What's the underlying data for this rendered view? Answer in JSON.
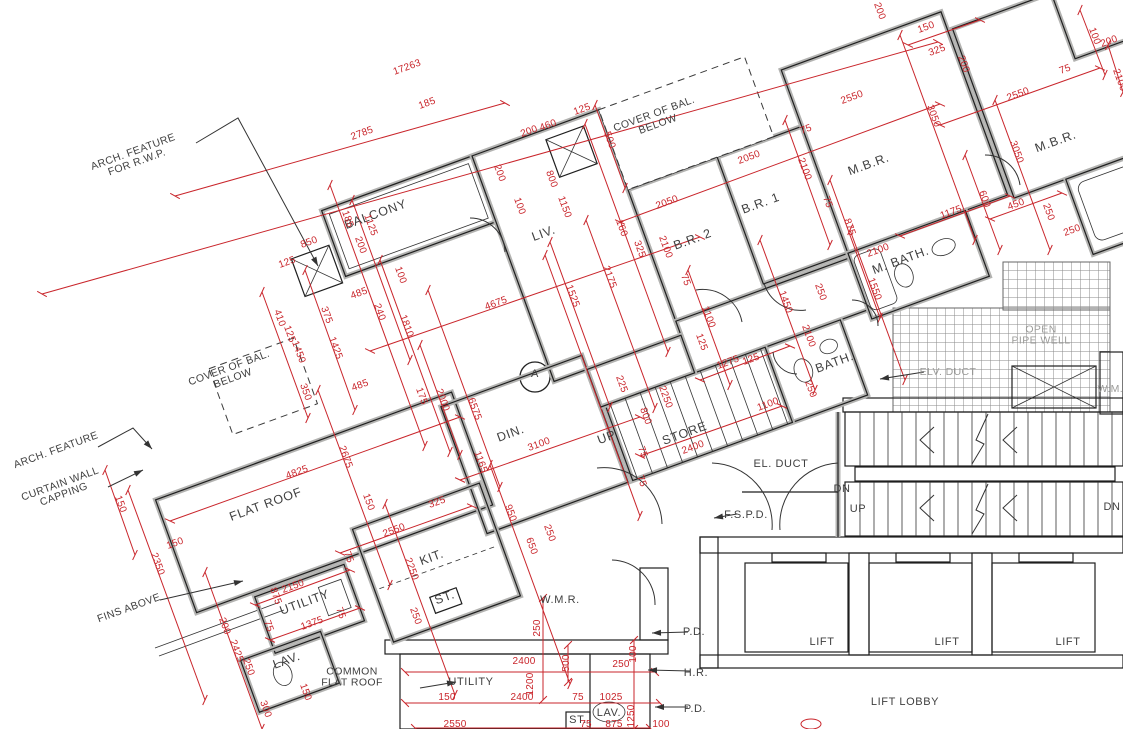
{
  "drawing": {
    "type": "architectural floor plan",
    "flat_marker": "A"
  },
  "colors": {
    "dimension_red": "#c9252b",
    "room_fill": "#e9f0f7",
    "teal_room_fill": "#cfe2e0",
    "wall_gray": "#b3b3b1",
    "line_black": "#222222",
    "muted_text": "#9b9b99",
    "label_text": "#3f3f3f"
  },
  "room_labels": [
    {
      "text": "BALCONY",
      "x": 377,
      "y": 218,
      "angle": -20
    },
    {
      "text": "LIV.",
      "x": 545,
      "y": 237,
      "angle": -20
    },
    {
      "text": "DIN.",
      "x": 512,
      "y": 437,
      "angle": -20
    },
    {
      "text": "B.R. 2",
      "x": 694,
      "y": 243,
      "angle": -20
    },
    {
      "text": "B.R. 1",
      "x": 762,
      "y": 207,
      "angle": -20
    },
    {
      "text": "M.B.R.",
      "x": 870,
      "y": 168,
      "angle": -20
    },
    {
      "text": "M.B.R.",
      "x": 1057,
      "y": 145,
      "angle": -20
    },
    {
      "text": "M. BATH.",
      "x": 902,
      "y": 264,
      "angle": -20,
      "size": 10
    },
    {
      "text": "BATH.",
      "x": 836,
      "y": 366,
      "angle": -20,
      "size": 10
    },
    {
      "text": "KIT.",
      "x": 433,
      "y": 561,
      "angle": -20
    },
    {
      "text": "STORE",
      "x": 686,
      "y": 437,
      "angle": -20,
      "size": 10
    },
    {
      "text": "UP",
      "x": 608,
      "y": 441,
      "angle": -20,
      "size": 10
    },
    {
      "text": "FLAT ROOF",
      "x": 267,
      "y": 508,
      "angle": -20
    },
    {
      "text": "UTILITY",
      "x": 306,
      "y": 606,
      "angle": -20,
      "size": 10
    },
    {
      "text": "LAV.",
      "x": 288,
      "y": 664,
      "angle": -20,
      "size": 10
    },
    {
      "text": "ST.",
      "x": 446,
      "y": 601,
      "angle": -20,
      "size": 9
    }
  ],
  "core_labels": [
    {
      "text": "UTILITY",
      "x": 471,
      "y": 685,
      "size": 11
    },
    {
      "text": "LAV.",
      "x": 609,
      "y": 716,
      "size": 9
    },
    {
      "text": "ST.",
      "x": 578,
      "y": 723,
      "size": 9
    },
    {
      "text": "W.M.R.",
      "x": 560,
      "y": 603
    },
    {
      "text": "LIFT",
      "x": 822,
      "y": 645
    },
    {
      "text": "LIFT",
      "x": 947,
      "y": 645
    },
    {
      "text": "LIFT",
      "x": 1068,
      "y": 645
    },
    {
      "text": "LIFT LOBBY",
      "x": 905,
      "y": 705
    },
    {
      "text": "EL. DUCT",
      "x": 781,
      "y": 467,
      "size": 10.5
    },
    {
      "text": "F.S.P.D.",
      "x": 746,
      "y": 518,
      "size": 10.5
    },
    {
      "text": "DN",
      "x": 842,
      "y": 492,
      "size": 10.5
    },
    {
      "text": "UP",
      "x": 858,
      "y": 512,
      "size": 10.5
    },
    {
      "text": "DN",
      "x": 1112,
      "y": 510,
      "size": 10.5
    },
    {
      "text": "P.D.",
      "x": 694,
      "y": 635,
      "size": 10.5
    },
    {
      "text": "H.R.",
      "x": 696,
      "y": 676,
      "size": 10.5
    },
    {
      "text": "P.D.",
      "x": 695,
      "y": 712,
      "size": 10.5
    }
  ],
  "muted_labels": [
    {
      "text": "OPEN\nPIPE WELL",
      "x": 1041,
      "y": 338
    },
    {
      "text": "ELV. DUCT",
      "x": 948,
      "y": 375
    },
    {
      "text": "W.M.R.",
      "x": 1116,
      "y": 392
    }
  ],
  "annotations": [
    {
      "text": "ARCH. FEATURE\nFOR R.W.P.",
      "x": 136,
      "y": 160,
      "angle": -20
    },
    {
      "text": "COVER OF BAL.\nBELOW",
      "x": 657,
      "y": 122,
      "angle": -20
    },
    {
      "text": "COVER OF BAL.\nBELOW",
      "x": 232,
      "y": 376,
      "angle": -20
    },
    {
      "text": "ARCH. FEATURE",
      "x": 57,
      "y": 453,
      "angle": -20
    },
    {
      "text": "CURTAIN WALL\nCAPPING",
      "x": 63,
      "y": 492,
      "angle": -20
    },
    {
      "text": "FINS ABOVE",
      "x": 130,
      "y": 611,
      "angle": -20
    },
    {
      "text": "COMMON\nFLAT ROOF",
      "x": 352,
      "y": 680
    }
  ],
  "flat_marker_label": {
    "text": "A",
    "x": 535,
    "y": 377
  },
  "dimensions": [
    {
      "text": "17263",
      "x": 408,
      "y": 70,
      "angle": -20
    },
    {
      "text": "2785",
      "x": 363,
      "y": 136,
      "angle": -20
    },
    {
      "text": "185",
      "x": 428,
      "y": 106,
      "angle": -20
    },
    {
      "text": "185",
      "x": 345,
      "y": 220,
      "angle": 70
    },
    {
      "text": "1125",
      "x": 368,
      "y": 226,
      "angle": 70
    },
    {
      "text": "200",
      "x": 358,
      "y": 246,
      "angle": 70
    },
    {
      "text": "100",
      "x": 398,
      "y": 276,
      "angle": 70
    },
    {
      "text": "850",
      "x": 310,
      "y": 245,
      "angle": -20
    },
    {
      "text": "125",
      "x": 288,
      "y": 265,
      "angle": -20
    },
    {
      "text": "485",
      "x": 360,
      "y": 296,
      "angle": -20
    },
    {
      "text": "240",
      "x": 377,
      "y": 313,
      "angle": 70
    },
    {
      "text": "1810",
      "x": 404,
      "y": 327,
      "angle": 70
    },
    {
      "text": "200",
      "x": 530,
      "y": 134,
      "angle": -20
    },
    {
      "text": "460",
      "x": 549,
      "y": 128,
      "angle": -20
    },
    {
      "text": "125",
      "x": 583,
      "y": 112,
      "angle": -20
    },
    {
      "text": "500",
      "x": 607,
      "y": 141,
      "angle": 70
    },
    {
      "text": "800",
      "x": 549,
      "y": 180,
      "angle": 70
    },
    {
      "text": "200",
      "x": 497,
      "y": 174,
      "angle": 70
    },
    {
      "text": "100",
      "x": 517,
      "y": 207,
      "angle": 70
    },
    {
      "text": "1150",
      "x": 562,
      "y": 208,
      "angle": 70
    },
    {
      "text": "4675",
      "x": 497,
      "y": 306,
      "angle": -20
    },
    {
      "text": "1525",
      "x": 570,
      "y": 297,
      "angle": 70
    },
    {
      "text": "2175",
      "x": 607,
      "y": 278,
      "angle": 70
    },
    {
      "text": "160",
      "x": 619,
      "y": 229,
      "angle": 70
    },
    {
      "text": "325",
      "x": 637,
      "y": 250,
      "angle": 70
    },
    {
      "text": "2100",
      "x": 663,
      "y": 248,
      "angle": 70
    },
    {
      "text": "2050",
      "x": 668,
      "y": 205,
      "angle": -20
    },
    {
      "text": "75",
      "x": 807,
      "y": 132,
      "angle": -20
    },
    {
      "text": "2050",
      "x": 750,
      "y": 160,
      "angle": -20
    },
    {
      "text": "2550",
      "x": 853,
      "y": 100,
      "angle": -20
    },
    {
      "text": "3050",
      "x": 931,
      "y": 117,
      "angle": 70
    },
    {
      "text": "2100",
      "x": 802,
      "y": 170,
      "angle": 70
    },
    {
      "text": "75",
      "x": 825,
      "y": 203,
      "angle": 70
    },
    {
      "text": "875",
      "x": 847,
      "y": 228,
      "angle": 70
    },
    {
      "text": "1175",
      "x": 952,
      "y": 215,
      "angle": -20
    },
    {
      "text": "600",
      "x": 982,
      "y": 200,
      "angle": 70
    },
    {
      "text": "1450",
      "x": 783,
      "y": 303,
      "angle": 70
    },
    {
      "text": "1550",
      "x": 872,
      "y": 290,
      "angle": 70
    },
    {
      "text": "250",
      "x": 818,
      "y": 293,
      "angle": 70
    },
    {
      "text": "2100",
      "x": 879,
      "y": 253,
      "angle": -20
    },
    {
      "text": "75",
      "x": 683,
      "y": 281,
      "angle": 70
    },
    {
      "text": "1100",
      "x": 706,
      "y": 318,
      "angle": 70
    },
    {
      "text": "125",
      "x": 699,
      "y": 343,
      "angle": 70
    },
    {
      "text": "1275",
      "x": 729,
      "y": 365,
      "angle": -20
    },
    {
      "text": "125",
      "x": 752,
      "y": 362,
      "angle": -20
    },
    {
      "text": "2100",
      "x": 806,
      "y": 337,
      "angle": 70
    },
    {
      "text": "250",
      "x": 808,
      "y": 390,
      "angle": 70
    },
    {
      "text": "225",
      "x": 619,
      "y": 385,
      "angle": 70
    },
    {
      "text": "800",
      "x": 643,
      "y": 417,
      "angle": 70
    },
    {
      "text": "2250",
      "x": 663,
      "y": 398,
      "angle": 70
    },
    {
      "text": "2400",
      "x": 694,
      "y": 450,
      "angle": -20
    },
    {
      "text": "1100",
      "x": 769,
      "y": 407,
      "angle": -20
    },
    {
      "text": "75",
      "x": 640,
      "y": 453,
      "angle": 70
    },
    {
      "text": "75",
      "x": 639,
      "y": 482,
      "angle": 70
    },
    {
      "text": "175",
      "x": 419,
      "y": 397,
      "angle": 70
    },
    {
      "text": "2000",
      "x": 440,
      "y": 401,
      "angle": 70
    },
    {
      "text": "6575",
      "x": 472,
      "y": 410,
      "angle": 70
    },
    {
      "text": "1165",
      "x": 478,
      "y": 463,
      "angle": 70
    },
    {
      "text": "3100",
      "x": 540,
      "y": 447,
      "angle": -20
    },
    {
      "text": "325",
      "x": 438,
      "y": 505,
      "angle": -20
    },
    {
      "text": "950",
      "x": 508,
      "y": 514,
      "angle": 70
    },
    {
      "text": "650",
      "x": 529,
      "y": 547,
      "angle": 70
    },
    {
      "text": "250",
      "x": 547,
      "y": 534,
      "angle": 70
    },
    {
      "text": "150",
      "x": 366,
      "y": 503,
      "angle": 70
    },
    {
      "text": "2550",
      "x": 395,
      "y": 533,
      "angle": -20
    },
    {
      "text": "2250",
      "x": 409,
      "y": 570,
      "angle": 70
    },
    {
      "text": "75",
      "x": 346,
      "y": 558,
      "angle": 70
    },
    {
      "text": "250",
      "x": 413,
      "y": 617,
      "angle": 70
    },
    {
      "text": "4825",
      "x": 298,
      "y": 475,
      "angle": -20
    },
    {
      "text": "2675",
      "x": 343,
      "y": 458,
      "angle": 70
    },
    {
      "text": "485",
      "x": 361,
      "y": 388,
      "angle": -20
    },
    {
      "text": "350",
      "x": 303,
      "y": 393,
      "angle": 70
    },
    {
      "text": "1425",
      "x": 333,
      "y": 349,
      "angle": 70
    },
    {
      "text": "375",
      "x": 324,
      "y": 316,
      "angle": 70
    },
    {
      "text": "410",
      "x": 277,
      "y": 319,
      "angle": 70
    },
    {
      "text": "125",
      "x": 287,
      "y": 335,
      "angle": 70
    },
    {
      "text": "1450",
      "x": 296,
      "y": 353,
      "angle": 70
    },
    {
      "text": "150",
      "x": 118,
      "y": 505,
      "angle": 70
    },
    {
      "text": "150",
      "x": 176,
      "y": 546,
      "angle": -20
    },
    {
      "text": "2350",
      "x": 155,
      "y": 565,
      "angle": 70
    },
    {
      "text": "200",
      "x": 222,
      "y": 627,
      "angle": 70
    },
    {
      "text": "2425",
      "x": 234,
      "y": 652,
      "angle": 70
    },
    {
      "text": "250",
      "x": 246,
      "y": 668,
      "angle": 70
    },
    {
      "text": "300",
      "x": 263,
      "y": 710,
      "angle": 70
    },
    {
      "text": "150",
      "x": 303,
      "y": 693,
      "angle": 70
    },
    {
      "text": "875",
      "x": 273,
      "y": 597,
      "angle": 70
    },
    {
      "text": "2150",
      "x": 294,
      "y": 589,
      "angle": -20
    },
    {
      "text": "75",
      "x": 266,
      "y": 627,
      "angle": 70
    },
    {
      "text": "1375",
      "x": 313,
      "y": 626,
      "angle": -20
    },
    {
      "text": "75",
      "x": 338,
      "y": 614,
      "angle": 70
    },
    {
      "text": "2550",
      "x": 1019,
      "y": 97,
      "angle": -20
    },
    {
      "text": "75",
      "x": 1066,
      "y": 72,
      "angle": -20
    },
    {
      "text": "100",
      "x": 1092,
      "y": 37,
      "angle": 70
    },
    {
      "text": "3050",
      "x": 1014,
      "y": 153,
      "angle": 70
    },
    {
      "text": "450",
      "x": 1017,
      "y": 207,
      "angle": -20
    },
    {
      "text": "250",
      "x": 1046,
      "y": 213,
      "angle": 70
    },
    {
      "text": "250",
      "x": 1073,
      "y": 233,
      "angle": -20
    },
    {
      "text": "200",
      "x": 877,
      "y": 12,
      "angle": 70
    },
    {
      "text": "150",
      "x": 927,
      "y": 30,
      "angle": -20
    },
    {
      "text": "325",
      "x": 938,
      "y": 53,
      "angle": -20
    },
    {
      "text": "200",
      "x": 961,
      "y": 65,
      "angle": 70
    },
    {
      "text": "200",
      "x": 1110,
      "y": 44,
      "angle": -20
    },
    {
      "text": "2100",
      "x": 1117,
      "y": 81,
      "angle": 70
    },
    {
      "text": "250",
      "x": 540,
      "y": 628,
      "angle": -90
    },
    {
      "text": "2400",
      "x": 524,
      "y": 664,
      "angle": 0
    },
    {
      "text": "500",
      "x": 569,
      "y": 663,
      "angle": -90
    },
    {
      "text": "1200",
      "x": 533,
      "y": 684,
      "angle": -90
    },
    {
      "text": "2400",
      "x": 522,
      "y": 700,
      "angle": 0
    },
    {
      "text": "150",
      "x": 447,
      "y": 700,
      "angle": 0
    },
    {
      "text": "75",
      "x": 578,
      "y": 700,
      "angle": 0
    },
    {
      "text": "1025",
      "x": 611,
      "y": 700,
      "angle": 0
    },
    {
      "text": "250",
      "x": 621,
      "y": 667,
      "angle": 0
    },
    {
      "text": "100",
      "x": 636,
      "y": 654,
      "angle": -90
    },
    {
      "text": "875",
      "x": 614,
      "y": 727,
      "angle": 0
    },
    {
      "text": "1250",
      "x": 634,
      "y": 716,
      "angle": -90
    },
    {
      "text": "2550",
      "x": 455,
      "y": 727,
      "angle": 0
    },
    {
      "text": "75",
      "x": 586,
      "y": 727,
      "angle": 0
    },
    {
      "text": "100",
      "x": 661,
      "y": 727,
      "angle": 0
    }
  ]
}
